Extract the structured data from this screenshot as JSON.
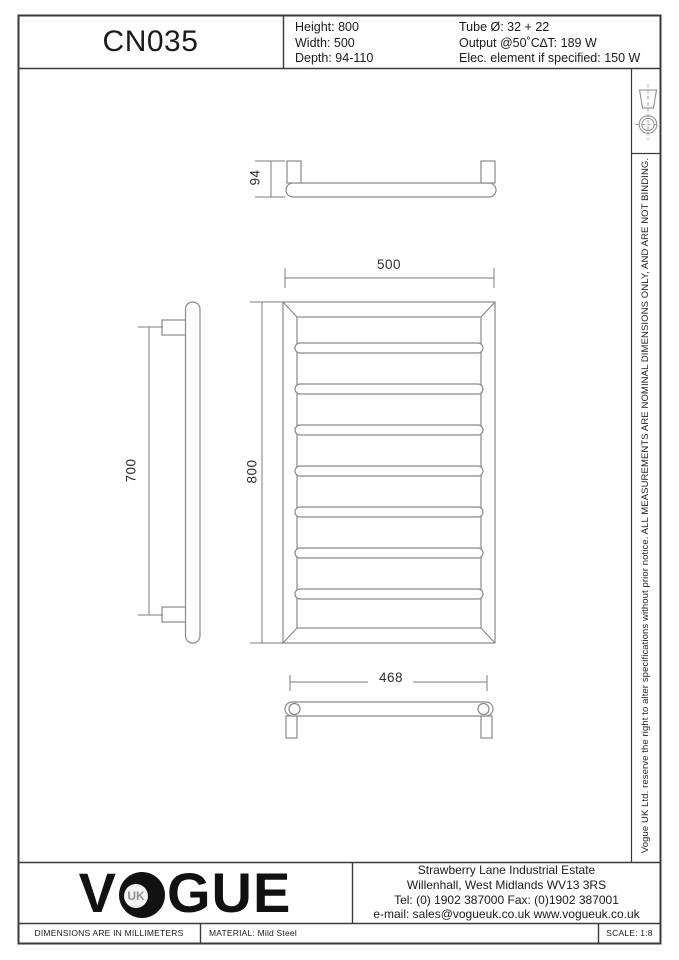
{
  "title_block": {
    "model": "CN035",
    "specs_left": [
      "Height: 800",
      "Width: 500",
      "Depth: 94-110"
    ],
    "specs_right": [
      "Tube Ø: 32 + 22",
      "Output @50˚C∆T: 189 W",
      "Elec. element if specified: 150 W"
    ]
  },
  "side_note": "Vogue UK Ltd. reserve the right to alter specifications without prior notice. ALL MEASUREMENTS ARE NOMINAL DIMENSIONS ONLY, AND ARE NOT BINDING.",
  "drawing": {
    "dimensions": {
      "depth": "94",
      "width": "500",
      "height": "800",
      "fixing_centres_vertical": "700",
      "fixing_centres_horizontal": "468"
    },
    "front_view": {
      "rung_centers_y": [
        348,
        389,
        430,
        471,
        512,
        553,
        594
      ]
    }
  },
  "footer": {
    "logo": {
      "pre": "V",
      "uk": "UK",
      "post": "GUE"
    },
    "address_lines": [
      "Strawberry Lane Industrial Estate",
      "Willenhall, West Midlands WV13 3RS",
      "Tel: (0) 1902 387000  Fax: (0)1902 387001",
      "e-mail: sales@vogueuk.co.uk  www.vogueuk.co.uk"
    ],
    "units_note": "DIMENSIONS ARE IN MILLIMETERS",
    "material": "MATERIAL: Mild Steel",
    "scale": "SCALE: 1:8"
  },
  "colors": {
    "border": "#3a3a3a",
    "drawing_line": "#8a8a8a",
    "text": "#1a1a1a",
    "logo": "#111111",
    "logo_uk": "#919191"
  }
}
